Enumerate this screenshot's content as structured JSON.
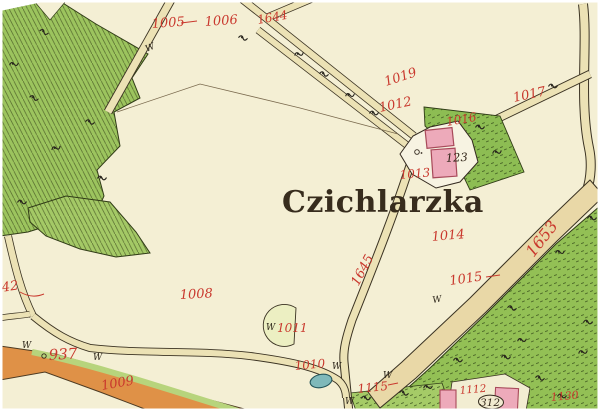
{
  "map": {
    "place_name": "Czichlarzka",
    "house_number": "123",
    "oval_number": "312",
    "symbols": {
      "meadow": "W"
    },
    "parcel_labels": {
      "p1005": "1005",
      "p1006": "1006",
      "p1644": "1644",
      "p1019": "1019",
      "p1012": "1012",
      "p1016": "1016",
      "p1017": "1017",
      "p1013": "1013",
      "p1014": "1014",
      "p1645": "1645",
      "p1653": "1653",
      "p1015": "1015",
      "p1008": "1008",
      "p1042": "1042",
      "p937": "937",
      "p1009": "1009",
      "p1010": "1010",
      "p1011": "1011",
      "p1115": "1115",
      "p1112": "1112",
      "p1130": "1130",
      "edge_fragment": "16"
    },
    "colors": {
      "background": "#f4efd4",
      "forest_green": "#9cc45e",
      "plot_green": "#8dbd53",
      "road_tan": "#ece2b5",
      "road_wide_tan": "#e9d8a7",
      "road_orange": "#df9147",
      "building_pink": "#edaaba",
      "building_outline": "#a84a5a",
      "pond_teal": "#7fb9ba",
      "label_red": "#c9382d",
      "ink_black": "#35291c",
      "pale_plot": "#ecefc2"
    }
  }
}
